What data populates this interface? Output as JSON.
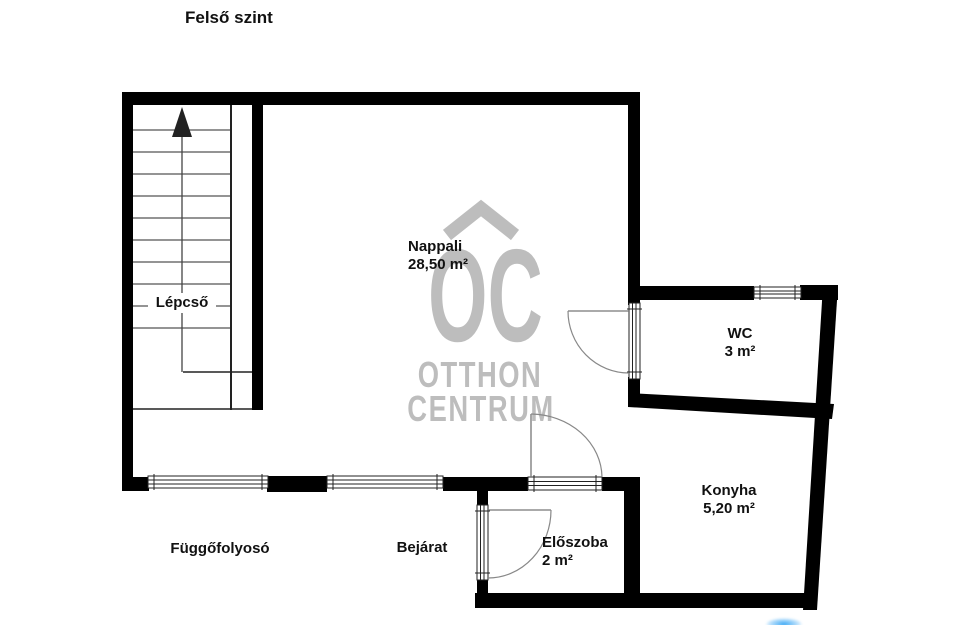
{
  "title": "Felső szint",
  "rooms": {
    "nappali": {
      "name": "Nappali",
      "area": "28,50 m²"
    },
    "wc": {
      "name": "WC",
      "area": "3 m²"
    },
    "konyha": {
      "name": "Konyha",
      "area": "5,20 m²"
    },
    "eloszoba": {
      "name": "Előszoba",
      "area": "2 m²"
    },
    "lepcso": {
      "name": "Lépcső"
    }
  },
  "annotations": {
    "entrance": "Bejárat",
    "corridor": "Függőfolyosó"
  },
  "watermark": {
    "symbol": "house-chevron-icon",
    "letters": "OC",
    "line1": "OTTHON",
    "line2": "CENTRUM"
  },
  "colors": {
    "wall": "#000000",
    "watermark_gray": "#bdbdbd",
    "text": "#111111",
    "logo_blue": "#3fa9f5"
  }
}
